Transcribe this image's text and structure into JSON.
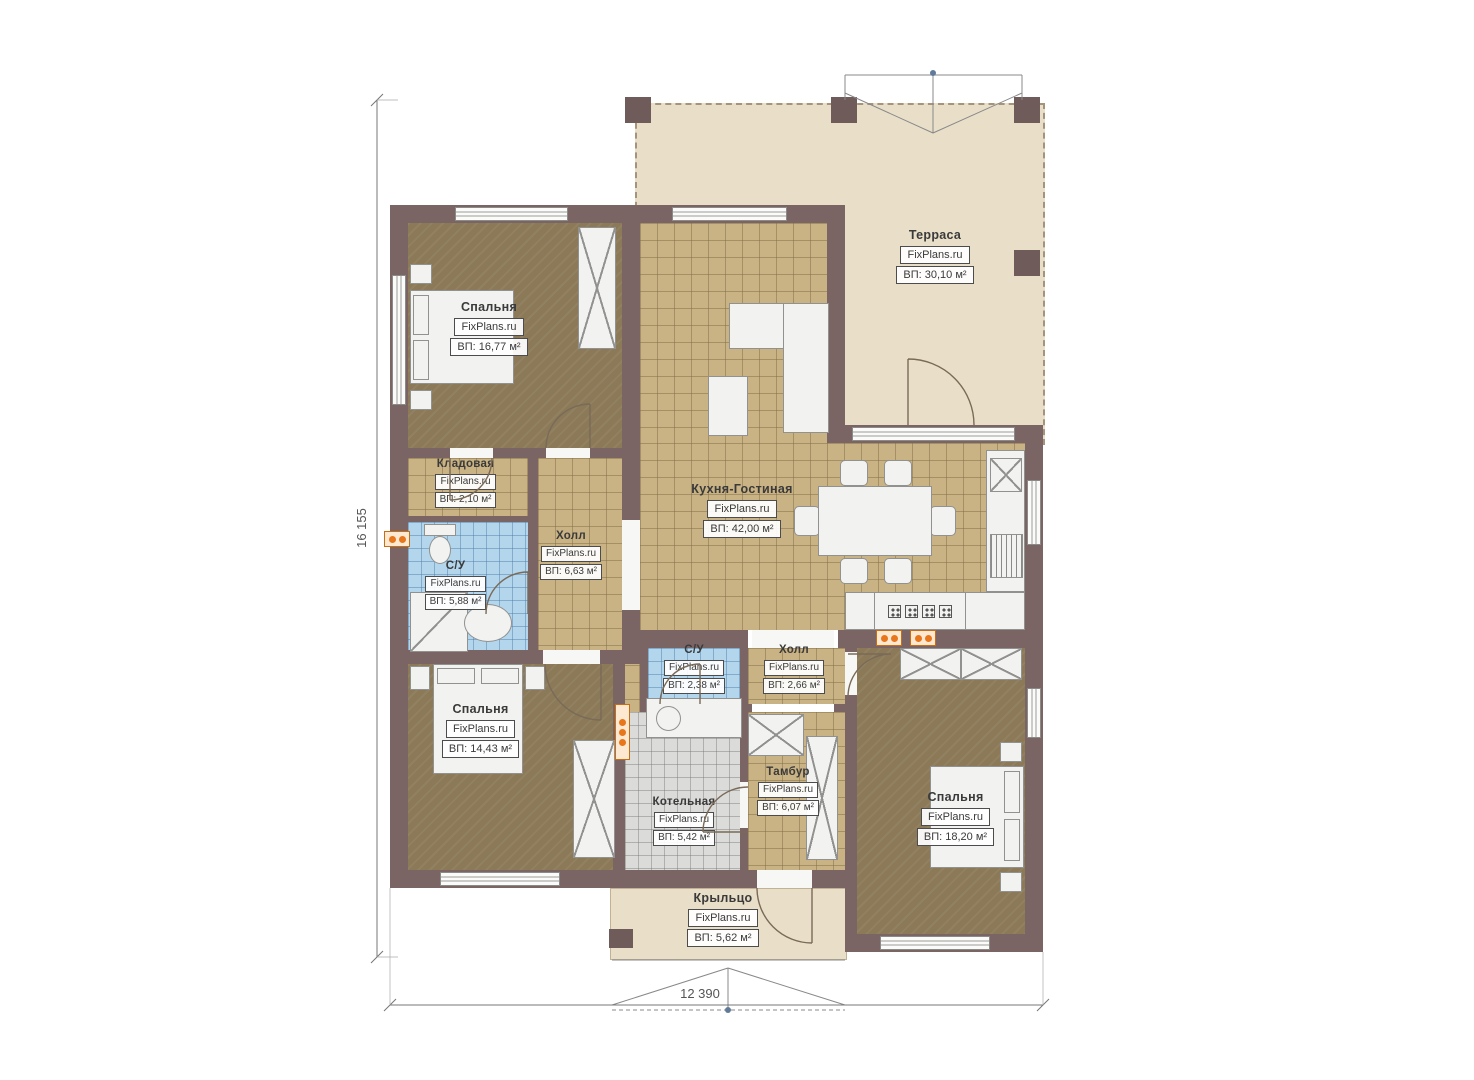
{
  "plan": {
    "brand": "FixPlans.ru",
    "dimensions": {
      "width_mm": "12 390",
      "height_mm": "16 155"
    },
    "rooms": {
      "terrace": {
        "name": "Терраса",
        "area": "ВП: 30,10 м²"
      },
      "bedroom1": {
        "name": "Спальня",
        "area": "ВП: 16,77 м²"
      },
      "storage": {
        "name": "Кладовая",
        "area": "ВП: 2,10 м²"
      },
      "bathroom1": {
        "name": "С/У",
        "area": "ВП: 5,88 м²"
      },
      "hall1": {
        "name": "Холл",
        "area": "ВП: 6,63 м²"
      },
      "kitchen_living": {
        "name": "Кухня-Гостиная",
        "area": "ВП: 42,00 м²"
      },
      "bedroom2": {
        "name": "Спальня",
        "area": "ВП: 14,43 м²"
      },
      "bathroom2": {
        "name": "С/У",
        "area": "ВП: 2,38 м²"
      },
      "hall2": {
        "name": "Холл",
        "area": "ВП: 2,66 м²"
      },
      "boiler": {
        "name": "Котельная",
        "area": "ВП: 5,42 м²"
      },
      "vestibule": {
        "name": "Тамбур",
        "area": "ВП: 6,07 м²"
      },
      "bedroom3": {
        "name": "Спальня",
        "area": "ВП: 18,20 м²"
      },
      "porch": {
        "name": "Крыльцо",
        "area": "ВП: 5,62 м²"
      }
    },
    "colors": {
      "wall": "#7b6564",
      "tile_floor": "#c9b283",
      "bedroom_floor": "#8b7957",
      "bath_floor": "#b3d6ec",
      "boiler_floor": "#dbdbd9",
      "terrace_floor": "#e9dfc9",
      "radiator": "#e8761a"
    }
  }
}
